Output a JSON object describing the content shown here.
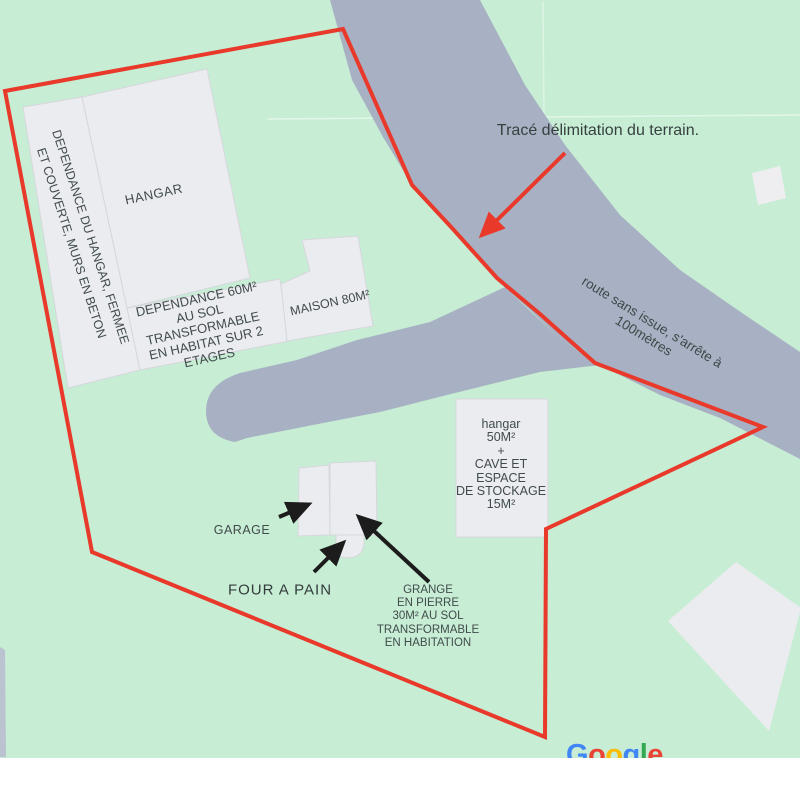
{
  "map": {
    "colors": {
      "background": "#c7edd4",
      "road": "#a8b1c3",
      "building_fill": "#ebecef",
      "building_stroke": "#d6d7dd",
      "boundary_red": "#e8392b",
      "arrow_black": "#1c1c1c",
      "label_text": "#414b4b"
    },
    "annotation": {
      "trace_label": "Tracé délimitation du terrain.",
      "road_label_line1": "route sans issue, s'arrête à",
      "road_label_line2": "100mètres"
    },
    "buildings": {
      "hangar": "HANGAR",
      "dependance_hangar_line1": "DEPENDANCE DU  HANGAR, FERMEE",
      "dependance_hangar_line2": "ET COUVERTE, MURS EN BETON",
      "dependance60": [
        "DEPENDANCE 60M²",
        "AU SOL",
        "TRANSFORMABLE",
        "EN HABITAT SUR 2",
        "ETAGES"
      ],
      "maison": "MAISON 80M²",
      "hangar50": [
        "hangar",
        "50M²",
        "+",
        "CAVE ET",
        "ESPACE",
        "DE STOCKAGE",
        "15M²"
      ],
      "garage": "GARAGE",
      "four_a_pain": "FOUR A PAIN",
      "grange": [
        "GRANGE",
        "EN PIERRE",
        "30M² AU SOL",
        "TRANSFORMABLE",
        "EN HABITATION"
      ]
    },
    "attribution": {
      "brand": "Google",
      "letters": [
        {
          "ch": "G",
          "color": "#4285F4"
        },
        {
          "ch": "o",
          "color": "#EA4335"
        },
        {
          "ch": "o",
          "color": "#FBBC05"
        },
        {
          "ch": "g",
          "color": "#4285F4"
        },
        {
          "ch": "l",
          "color": "#34A853"
        },
        {
          "ch": "e",
          "color": "#EA4335"
        }
      ]
    }
  }
}
